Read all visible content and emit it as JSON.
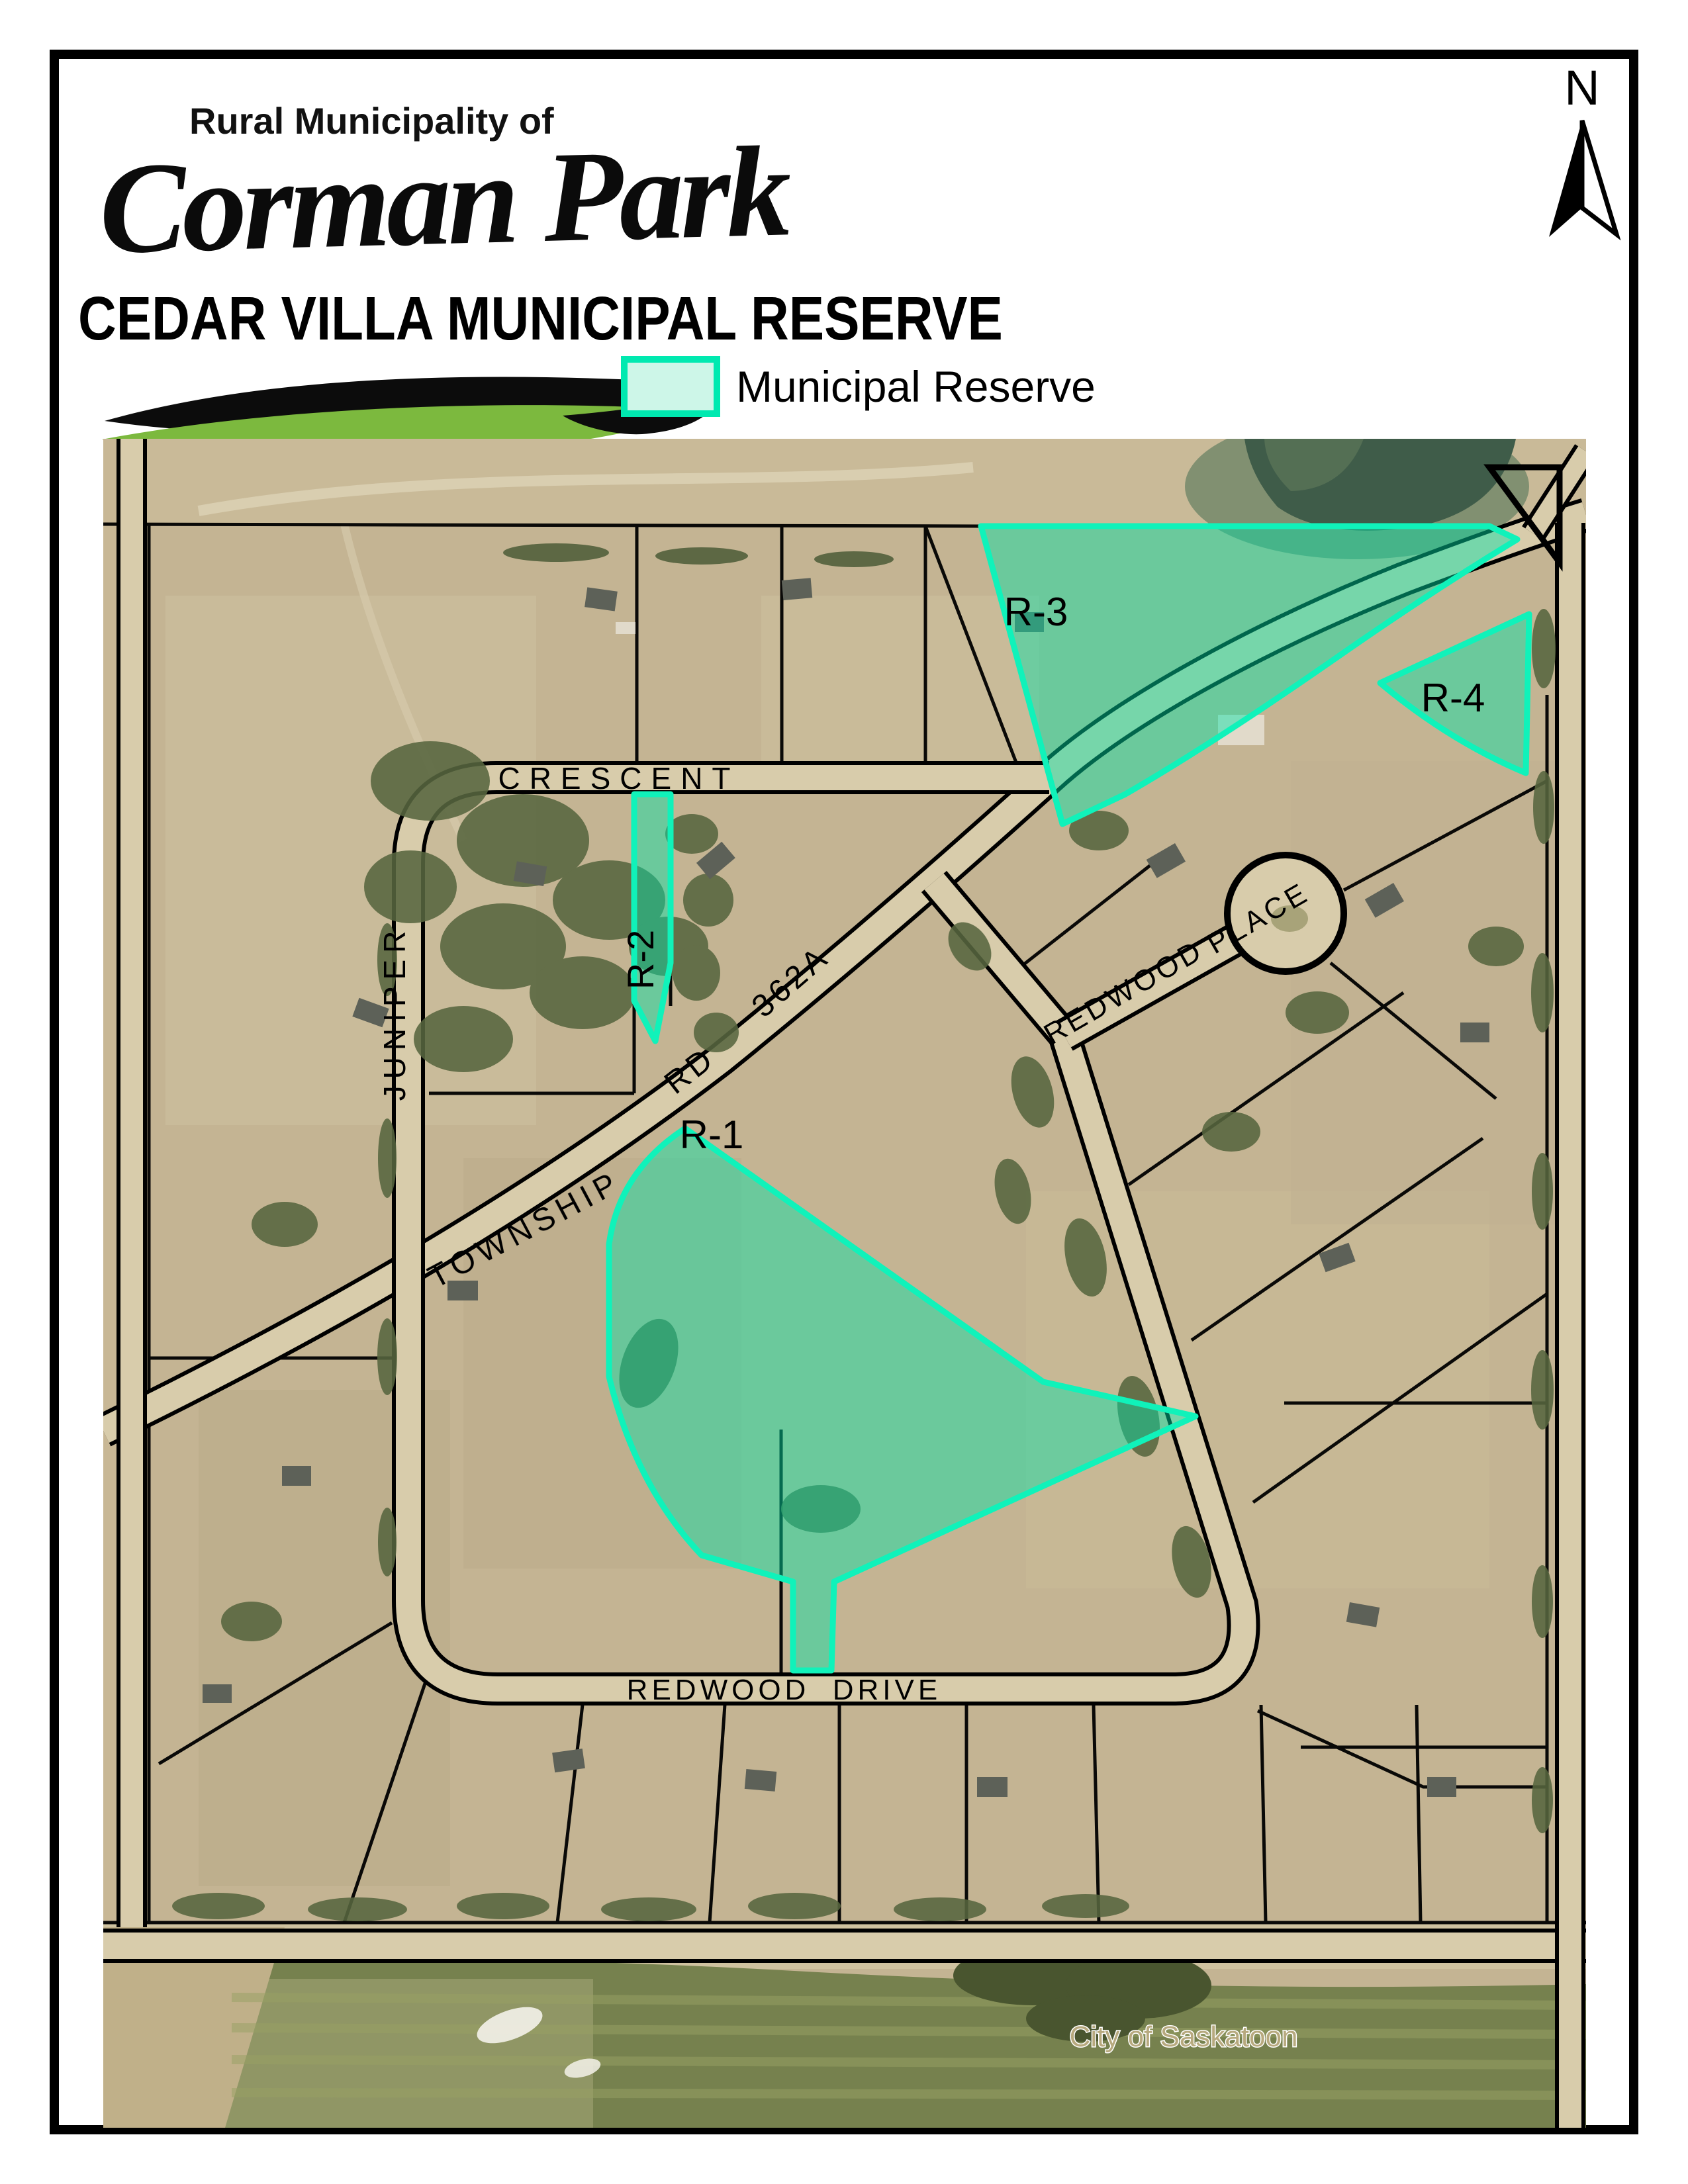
{
  "page": {
    "background": "#ffffff",
    "frame_color": "#000000"
  },
  "logo": {
    "tagline": "Rural Municipality of",
    "name": "Corman Park",
    "swoosh_black": "#0c0c0c",
    "swoosh_green": "#7cb93e"
  },
  "title": "CEDAR VILLA MUNICIPAL RESERVE",
  "legend": {
    "label": "Municipal Reserve",
    "swatch_fill": "#cdf6e8",
    "swatch_border": "#00e9b0"
  },
  "compass": {
    "label": "N"
  },
  "map": {
    "streets": {
      "crescent": "CRESCENT",
      "juniper": "JUNIPER",
      "township": "TOWNSHIP",
      "rd": "RD",
      "hwy": "362A",
      "redwood": "REDWOOD",
      "place": "PLACE",
      "drive": "DRIVE"
    },
    "reserves": [
      {
        "id": "R-1"
      },
      {
        "id": "R-2"
      },
      {
        "id": "R-3"
      },
      {
        "id": "R-4"
      }
    ],
    "city_label": "City of Saskatoon",
    "colors": {
      "reserve_fill": "rgba(0,226,168,0.45)",
      "reserve_stroke": "#10f2ba",
      "land": "#c4b493",
      "road": "#d8ccab",
      "water": "#3f5c49",
      "field_green": "#76814e"
    }
  }
}
